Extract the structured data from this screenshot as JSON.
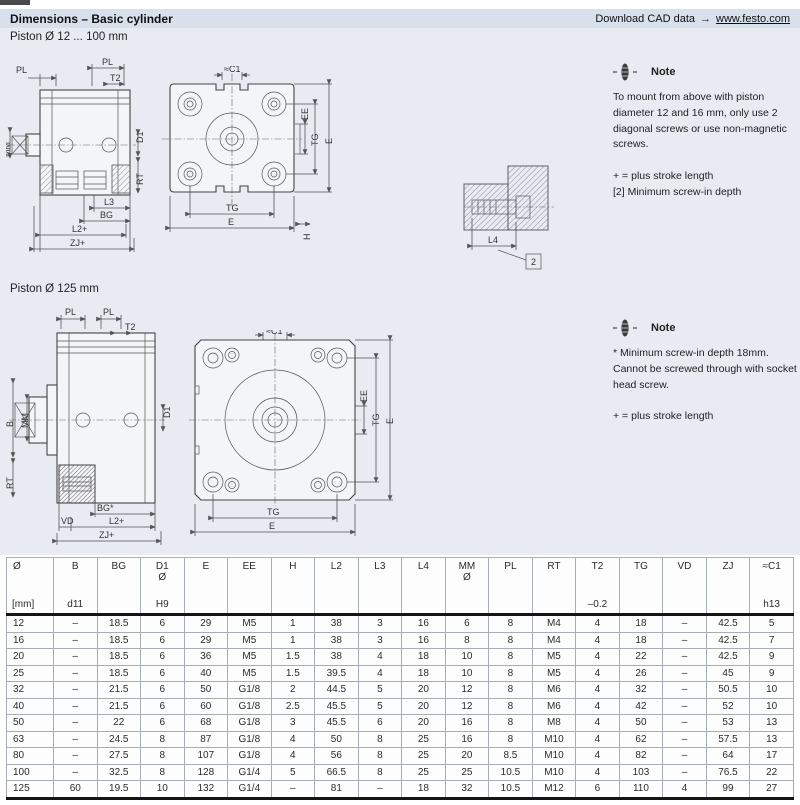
{
  "header": {
    "title": "Dimensions – Basic cylinder",
    "cad_text": "Download CAD data",
    "cad_arrow": "→",
    "cad_link": "www.festo.com"
  },
  "sections": {
    "s1_title": "Piston Ø 12 ... 100 mm",
    "s2_title": "Piston Ø 125 mm"
  },
  "notes": {
    "note1": {
      "title": "Note",
      "body": "To mount from above with piston diameter 12 and 16 mm, only use 2 diagonal screws or use non-magnetic screws.",
      "legend1": "+ = plus stroke length",
      "legend2": "[2] Minimum screw-in depth"
    },
    "note2": {
      "title": "Note",
      "body": "* Minimum screw-in depth 18mm. Cannot be screwed through with socket head screw.",
      "legend1": "+ = plus stroke length"
    }
  },
  "drawings": {
    "side_small": {
      "pl_left": "PL",
      "pl_right": "PL",
      "t2": "T2",
      "mm": "MM",
      "d1": "D1",
      "rt": "RT",
      "l3": "L3",
      "bg": "BG",
      "l2": "L2+",
      "zj": "ZJ+"
    },
    "front_small": {
      "c1": "≈C1",
      "ee": "EE",
      "tg_v": "TG",
      "e_v": "E",
      "tg_b": "TG",
      "e_b": "E",
      "h": "H"
    },
    "screw_detail": {
      "l4": "L4",
      "ref2": "2"
    },
    "side_large": {
      "pl_left": "PL",
      "pl_right": "PL",
      "t2": "T2",
      "b": "B",
      "mm": "MM",
      "d1": "D1",
      "rt": "RT",
      "bg": "BG*",
      "vd": "VD",
      "l2": "L2+",
      "zj": "ZJ+"
    },
    "front_large": {
      "c1": "≈C1",
      "ee": "EE",
      "tg_v": "TG",
      "e_v": "E",
      "tg_b": "TG",
      "e_b": "E"
    }
  },
  "table": {
    "headers": [
      {
        "top": "Ø",
        "mid": "",
        "bottom": "[mm]"
      },
      {
        "top": "B",
        "mid": "",
        "bottom": "d11"
      },
      {
        "top": "BG",
        "mid": "",
        "bottom": ""
      },
      {
        "top": "D1",
        "mid": "Ø",
        "bottom": "H9"
      },
      {
        "top": "E",
        "mid": "",
        "bottom": ""
      },
      {
        "top": "EE",
        "mid": "",
        "bottom": ""
      },
      {
        "top": "H",
        "mid": "",
        "bottom": ""
      },
      {
        "top": "L2",
        "mid": "",
        "bottom": ""
      },
      {
        "top": "L3",
        "mid": "",
        "bottom": ""
      },
      {
        "top": "L4",
        "mid": "",
        "bottom": ""
      },
      {
        "top": "MM",
        "mid": "Ø",
        "bottom": ""
      },
      {
        "top": "PL",
        "mid": "",
        "bottom": ""
      },
      {
        "top": "RT",
        "mid": "",
        "bottom": ""
      },
      {
        "top": "T2",
        "mid": "",
        "bottom": "–0.2"
      },
      {
        "top": "TG",
        "mid": "",
        "bottom": ""
      },
      {
        "top": "VD",
        "mid": "",
        "bottom": ""
      },
      {
        "top": "ZJ",
        "mid": "",
        "bottom": ""
      },
      {
        "top": "≈C1",
        "mid": "",
        "bottom": "h13"
      }
    ],
    "rows": [
      [
        "12",
        "–",
        "18.5",
        "6",
        "29",
        "M5",
        "1",
        "38",
        "3",
        "16",
        "6",
        "8",
        "M4",
        "4",
        "18",
        "–",
        "42.5",
        "5"
      ],
      [
        "16",
        "–",
        "18.5",
        "6",
        "29",
        "M5",
        "1",
        "38",
        "3",
        "16",
        "8",
        "8",
        "M4",
        "4",
        "18",
        "–",
        "42.5",
        "7"
      ],
      [
        "20",
        "–",
        "18.5",
        "6",
        "36",
        "M5",
        "1.5",
        "38",
        "4",
        "18",
        "10",
        "8",
        "M5",
        "4",
        "22",
        "–",
        "42.5",
        "9"
      ],
      [
        "25",
        "–",
        "18.5",
        "6",
        "40",
        "M5",
        "1.5",
        "39.5",
        "4",
        "18",
        "10",
        "8",
        "M5",
        "4",
        "26",
        "–",
        "45",
        "9"
      ],
      [
        "32",
        "–",
        "21.5",
        "6",
        "50",
        "G1/8",
        "2",
        "44.5",
        "5",
        "20",
        "12",
        "8",
        "M6",
        "4",
        "32",
        "–",
        "50.5",
        "10"
      ],
      [
        "40",
        "–",
        "21.5",
        "6",
        "60",
        "G1/8",
        "2.5",
        "45.5",
        "5",
        "20",
        "12",
        "8",
        "M6",
        "4",
        "42",
        "–",
        "52",
        "10"
      ],
      [
        "50",
        "–",
        "22",
        "6",
        "68",
        "G1/8",
        "3",
        "45.5",
        "6",
        "20",
        "16",
        "8",
        "M8",
        "4",
        "50",
        "–",
        "53",
        "13"
      ],
      [
        "63",
        "–",
        "24.5",
        "8",
        "87",
        "G1/8",
        "4",
        "50",
        "8",
        "25",
        "16",
        "8",
        "M10",
        "4",
        "62",
        "–",
        "57.5",
        "13"
      ],
      [
        "80",
        "–",
        "27.5",
        "8",
        "107",
        "G1/8",
        "4",
        "56",
        "8",
        "25",
        "20",
        "8.5",
        "M10",
        "4",
        "82",
        "–",
        "64",
        "17"
      ],
      [
        "100",
        "–",
        "32.5",
        "8",
        "128",
        "G1/4",
        "5",
        "66.5",
        "8",
        "25",
        "25",
        "10.5",
        "M10",
        "4",
        "103",
        "–",
        "76.5",
        "22"
      ],
      [
        "125",
        "60",
        "19.5",
        "10",
        "132",
        "G1/4",
        "–",
        "81",
        "–",
        "18",
        "32",
        "10.5",
        "M12",
        "6",
        "110",
        "4",
        "99",
        "27"
      ]
    ]
  }
}
